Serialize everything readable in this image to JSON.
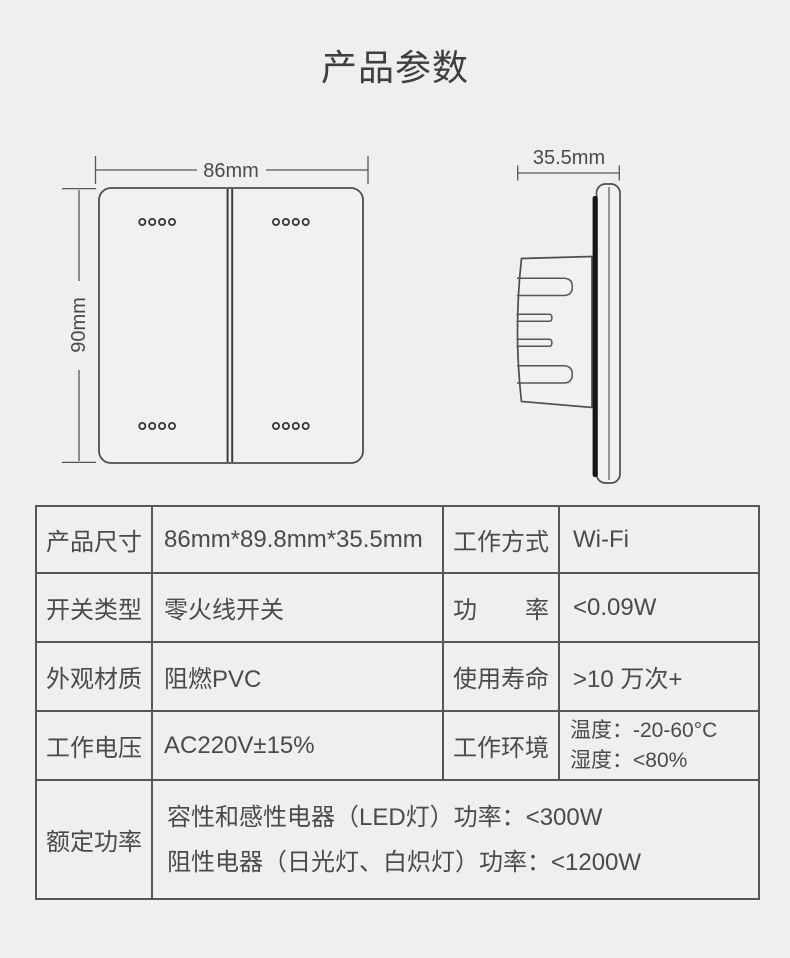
{
  "page": {
    "title": "产品参数"
  },
  "diagram": {
    "front": {
      "width_label": "86mm",
      "height_label": "90mm"
    },
    "side": {
      "depth_label": "35.5mm"
    }
  },
  "table": {
    "rows": [
      {
        "c0": "产品尺寸",
        "c1": "86mm*89.8mm*35.5mm",
        "c2": "工作方式",
        "c3": "Wi-Fi"
      },
      {
        "c0": "开关类型",
        "c1": "零火线开关",
        "c2": "功率",
        "c3": "<0.09W"
      },
      {
        "c0": "外观材质",
        "c1": "阻燃PVC",
        "c2": "使用寿命",
        "c3": ">10 万次+"
      },
      {
        "c0": "工作电压",
        "c1": "AC220V±15%",
        "c2": "工作环境",
        "c3_line1": "温度：-20-60°C",
        "c3_line2": "湿度：<80%"
      },
      {
        "c0": "额定功率",
        "v_line1": "容性和感性电器（LED灯）功率：<300W",
        "v_line2": "阻性电器（日光灯、白炽灯）功率：<1200W"
      }
    ]
  },
  "colors": {
    "background": "#efefef",
    "table_border": "#55555a",
    "text": "#4a4a4e",
    "outline_stroke": "#4e4e52",
    "seam_black": "#161616"
  }
}
